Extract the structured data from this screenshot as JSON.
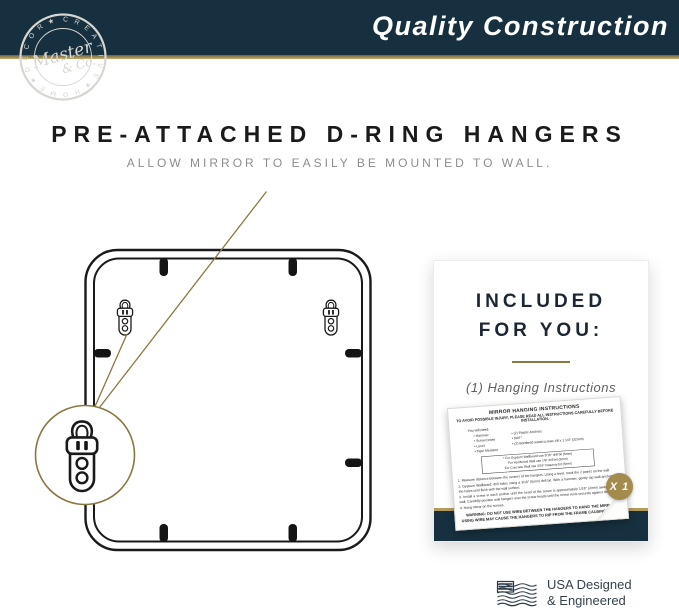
{
  "brand_banner": {
    "title": "Quality Construction"
  },
  "logo": {
    "ring_text": "C R E A T I V E ★ H O M E ★ D E C O R ★",
    "script_line1": "Master",
    "script_line2": "& Co."
  },
  "hero": {
    "title": "PRE-ATTACHED D-RING HANGERS",
    "subtitle": "ALLOW MIRROR TO EASILY BE MOUNTED TO WALL."
  },
  "included_card": {
    "title_line1": "INCLUDED",
    "title_line2": "FOR YOU:",
    "item_label": "(1) Hanging Instructions",
    "quantity_badge": "X 1",
    "paper": {
      "title": "MIRROR HANGING INSTRUCTIONS",
      "caution": "TO AVOID POSSIBLE INJURY, PLEASE READ ALL INSTRUCTIONS CAREFULLY BEFORE INSTALLATION.",
      "you_will_need": "You will need:",
      "tools_left": [
        "• Hammer",
        "• Screw Driver",
        "• Level",
        "• Tape Measure"
      ],
      "tools_right": [
        "• (2) Plastic Anchors",
        "• Drill *",
        "• (2) Bordered wood screws #8 x 1 1/4\" (32mm)"
      ],
      "drill_notes": [
        "* For Gypsum Wallboard use 3/16\" drill bit (5mm)",
        "For Hardwood Wall use 1/8\" drill bit (3mm)",
        "For Concrete Wall use 3/16\" masonry bit (5mm)"
      ],
      "steps": [
        "1.  Measure distance between the centers of the hangers. Using a level, mark the 2 points on the wall.",
        "2.  Gypsum Wallboard: drill holes using a 3/16\" (5mm) drill bit. With a hammer, gently tap wall anchors into the holes until flush with the wall surface.",
        "3.  Install a screw in each anchor until the head of the screw is approximately 1/16\" (2mm) away from the wall. Carefully position wall hangers over the screw heads until the mirror rests securely against the wall.",
        "4.  Hang mirror on the screws."
      ],
      "warning": "WARNING: DO NOT USE WIRE BETWEEN THE HANGERS TO HANG THE MIRROR. USING WIRE MAY CAUSE THE HANGERS TO RIP FROM THE FRAME CAUSING INJURY."
    }
  },
  "made_in": {
    "line1": "USA Designed",
    "line2": "& Engineered"
  },
  "colors": {
    "navy": "#17303f",
    "gold_divider": "#b29c5e",
    "gold_line": "#8a7843",
    "badge_gold": "#a38b4d",
    "stamp": "#d8d6d0"
  }
}
